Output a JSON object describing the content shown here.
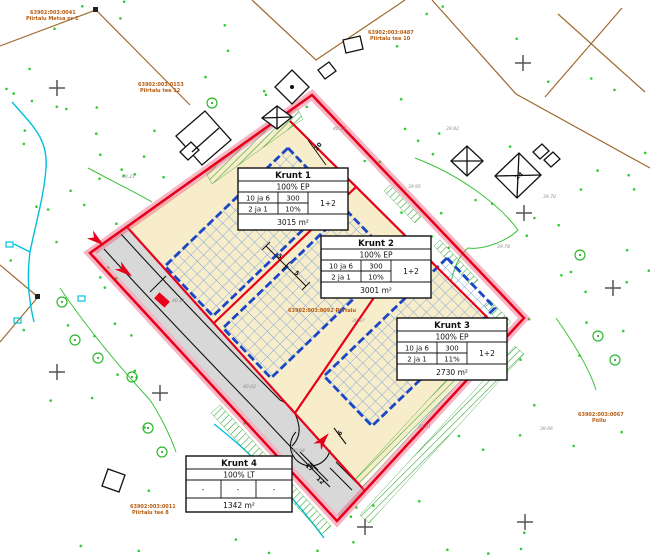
{
  "map": {
    "title": "Detailplaneering – krundijaotus",
    "plots": [
      {
        "title": "Krunt 1",
        "usage": "100% EP",
        "r1c1": "10 ja 6",
        "r1c2": "300",
        "r2c1": "2 ja 1",
        "r2c2": "10%",
        "floors": "1+2",
        "area": "3015 m²"
      },
      {
        "title": "Krunt 2",
        "usage": "100% EP",
        "r1c1": "10 ja 6",
        "r1c2": "300",
        "r2c1": "2 ja 1",
        "r2c2": "10%",
        "floors": "1+2",
        "area": "3001 m²"
      },
      {
        "title": "Krunt 3",
        "usage": "100% EP",
        "r1c1": "10 ja 6",
        "r1c2": "300",
        "r2c1": "2 ja 1",
        "r2c2": "11%",
        "floors": "1+2",
        "area": "2730 m²"
      },
      {
        "title": "Krunt 4",
        "usage": "100% LT",
        "d1": "-",
        "d2": "-",
        "d3": "-",
        "area": "1342 m²"
      }
    ],
    "cadastral_labels": [
      {
        "line1": "63902:003:0041",
        "line2": "Piirtalu Metsa nr 1"
      },
      {
        "line1": "63902:003:0487",
        "line2": "Piirtalu tee 10"
      },
      {
        "line1": "63902:003:0153",
        "line2": "Piirtalu tee 12"
      },
      {
        "line1": "63902:003:0067",
        "line2": "Põllu"
      },
      {
        "line1": "63902:003:0011",
        "line2": "Piirtalu tee 8"
      },
      {
        "line1": "63902:003:0092  Piirtalu",
        "line2": ""
      }
    ],
    "dimensions": {
      "setback_ne": "20",
      "side1": "5",
      "side2": "5",
      "road_w1": "17",
      "road_w2": "12",
      "road_w3": "6"
    },
    "spot_heights": [
      "40.12",
      "40.08",
      "39.95",
      "39.87",
      "39.90",
      "40.02",
      "40.11",
      "39.78",
      "39.91",
      "39.70",
      "40.21",
      "40.04",
      "39.82",
      "39.66"
    ],
    "symbols": {
      "shed_label": "24"
    },
    "colors": {
      "boundary_red": "#e8001a",
      "boundary_halo": "#ec5078",
      "plot_fill": "#f8edca",
      "envelope_blue": "#1a46c8",
      "hatch_blue": "#7aa6da",
      "road_gray": "#d8d8d8",
      "vegetation_green": "#2db82d",
      "hatch_green": "#1f9e1f",
      "water_cyan": "#00c0dc",
      "cadastral_orange": "#b85c10",
      "parcel_brown": "#a06a30"
    }
  }
}
